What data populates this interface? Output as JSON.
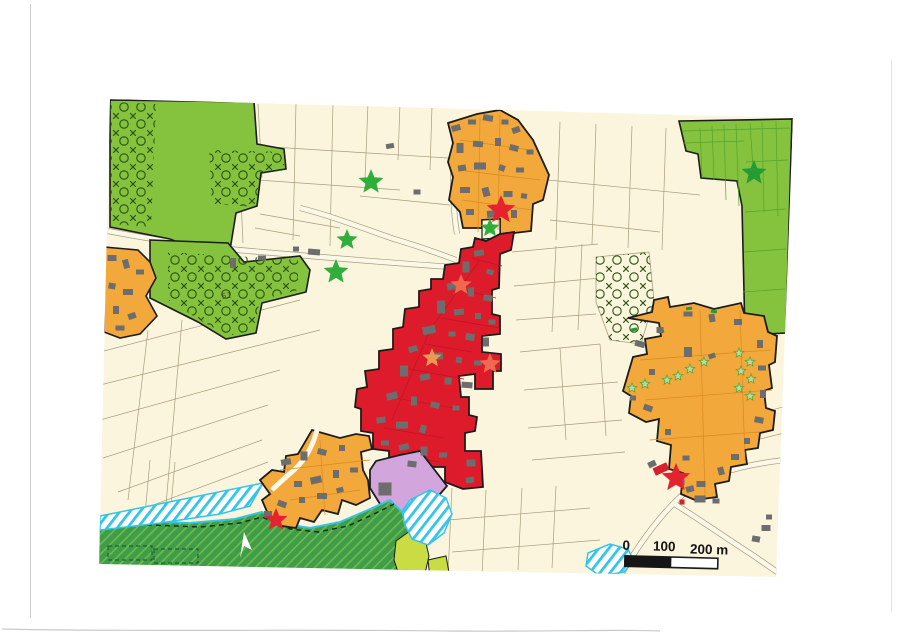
{
  "page": {
    "background": "#ffffff"
  },
  "map": {
    "colors": {
      "paper": "#ffffff",
      "field_beige": "#faf5dc",
      "road_fill": "#fcf8e8",
      "zone_green": "#85c23d",
      "zone_green_dark": "#3f9d4a",
      "zone_chartreuse": "#cadc44",
      "zone_orange": "#f2a83a",
      "zone_red": "#dd1b2b",
      "zone_purple": "#d2a5dc",
      "cyan": "#35c4e8",
      "building_gray": "#6e6d6e",
      "building_red": "#d8202c",
      "outline_black": "#1c1c1c",
      "parcel_line": "#a79d7e",
      "pattern_ink": "#27500f",
      "red_inner_line": "#c01425",
      "orange_inner_line": "#d98a1f",
      "star_green": "#2fae3c",
      "star_dark_green": "#259b35",
      "star_red": "#e52330",
      "star_faint_red": "#ee6a4f",
      "star_faint_orange": "#e89a55",
      "star_pale_green": "#badc9a",
      "star_pale_outline": "#58a546",
      "scale_black": "#161616"
    },
    "scale_bar": {
      "tick_0": "0",
      "tick_100": "100",
      "tick_200": "200 m"
    },
    "labels": {
      "parcel_number": "51"
    },
    "stars": [
      {
        "name": "green-star",
        "x": 371,
        "y": 182,
        "size": 13,
        "color": "star_green"
      },
      {
        "name": "green-star",
        "x": 347,
        "y": 240,
        "size": 11,
        "color": "star_green"
      },
      {
        "name": "green-star",
        "x": 336,
        "y": 272,
        "size": 13,
        "color": "star_green"
      },
      {
        "name": "green-star",
        "x": 490,
        "y": 228,
        "size": 10,
        "color": "star_green"
      },
      {
        "name": "dark-green-star",
        "x": 754,
        "y": 173,
        "size": 13,
        "color": "star_dark_green"
      },
      {
        "name": "red-star",
        "x": 501,
        "y": 210,
        "size": 15,
        "color": "star_red"
      },
      {
        "name": "red-star",
        "x": 676,
        "y": 478,
        "size": 15,
        "color": "star_red"
      },
      {
        "name": "red-star",
        "x": 276,
        "y": 520,
        "size": 12,
        "color": "star_red"
      },
      {
        "name": "faint-red-star",
        "x": 461,
        "y": 285,
        "size": 11,
        "color": "star_faint_red"
      },
      {
        "name": "faint-orange-star",
        "x": 432,
        "y": 358,
        "size": 10,
        "color": "star_faint_orange"
      },
      {
        "name": "faint-red-star",
        "x": 490,
        "y": 364,
        "size": 11,
        "color": "star_faint_red"
      },
      {
        "name": "pale-green-star",
        "x": 739,
        "y": 353,
        "size": 5,
        "color": "star_pale_green",
        "outline": "star_pale_outline"
      },
      {
        "name": "pale-green-star",
        "x": 750,
        "y": 362,
        "size": 5,
        "color": "star_pale_green",
        "outline": "star_pale_outline"
      },
      {
        "name": "pale-green-star",
        "x": 741,
        "y": 371,
        "size": 5,
        "color": "star_pale_green",
        "outline": "star_pale_outline"
      },
      {
        "name": "pale-green-star",
        "x": 751,
        "y": 379,
        "size": 5,
        "color": "star_pale_green",
        "outline": "star_pale_outline"
      },
      {
        "name": "pale-green-star",
        "x": 739,
        "y": 388,
        "size": 5,
        "color": "star_pale_green",
        "outline": "star_pale_outline"
      },
      {
        "name": "pale-green-star",
        "x": 750,
        "y": 396,
        "size": 5,
        "color": "star_pale_green",
        "outline": "star_pale_outline"
      },
      {
        "name": "pale-green-star",
        "x": 704,
        "y": 362,
        "size": 5,
        "color": "star_pale_green",
        "outline": "star_pale_outline"
      },
      {
        "name": "pale-green-star",
        "x": 690,
        "y": 369,
        "size": 5,
        "color": "star_pale_green",
        "outline": "star_pale_outline"
      },
      {
        "name": "pale-green-star",
        "x": 678,
        "y": 376,
        "size": 5,
        "color": "star_pale_green",
        "outline": "star_pale_outline"
      },
      {
        "name": "pale-green-star",
        "x": 667,
        "y": 380,
        "size": 5,
        "color": "star_pale_green",
        "outline": "star_pale_outline"
      },
      {
        "name": "pale-green-star",
        "x": 645,
        "y": 384,
        "size": 5,
        "color": "star_pale_green",
        "outline": "star_pale_outline"
      },
      {
        "name": "pale-green-star",
        "x": 632,
        "y": 388,
        "size": 5,
        "color": "star_pale_green",
        "outline": "star_pale_outline"
      }
    ],
    "buildings": {
      "gray": [
        [
          456,
          128,
          9,
          6,
          -15
        ],
        [
          472,
          122,
          8,
          5,
          0
        ],
        [
          488,
          118,
          10,
          6,
          10
        ],
        [
          505,
          122,
          7,
          5,
          0
        ],
        [
          516,
          130,
          8,
          6,
          -20
        ],
        [
          460,
          148,
          7,
          10,
          0
        ],
        [
          478,
          144,
          10,
          6,
          5
        ],
        [
          498,
          142,
          6,
          8,
          0
        ],
        [
          514,
          148,
          9,
          6,
          15
        ],
        [
          530,
          152,
          7,
          5,
          0
        ],
        [
          462,
          168,
          8,
          6,
          -10
        ],
        [
          480,
          166,
          12,
          7,
          0
        ],
        [
          502,
          168,
          6,
          6,
          20
        ],
        [
          520,
          170,
          8,
          5,
          0
        ],
        [
          465,
          190,
          10,
          6,
          0
        ],
        [
          486,
          192,
          7,
          9,
          -15
        ],
        [
          508,
          194,
          9,
          6,
          0
        ],
        [
          524,
          196,
          6,
          5,
          10
        ],
        [
          470,
          212,
          8,
          6,
          0
        ],
        [
          492,
          214,
          10,
          7,
          -5
        ],
        [
          514,
          214,
          6,
          8,
          0
        ],
        [
          479,
          253,
          10,
          6,
          -8
        ],
        [
          466,
          267,
          7,
          11,
          0
        ],
        [
          490,
          272,
          7,
          5,
          15
        ],
        [
          453,
          286,
          12,
          7,
          -12
        ],
        [
          471,
          292,
          6,
          9,
          0
        ],
        [
          488,
          298,
          9,
          6,
          8
        ],
        [
          441,
          307,
          8,
          13,
          0
        ],
        [
          459,
          312,
          10,
          6,
          -6
        ],
        [
          478,
          316,
          6,
          6,
          0
        ],
        [
          492,
          322,
          7,
          5,
          0
        ],
        [
          429,
          330,
          13,
          8,
          -12
        ],
        [
          452,
          334,
          7,
          5,
          0
        ],
        [
          470,
          337,
          9,
          7,
          12
        ],
        [
          486,
          342,
          6,
          9,
          0
        ],
        [
          413,
          349,
          9,
          6,
          -18
        ],
        [
          437,
          356,
          12,
          7,
          0
        ],
        [
          459,
          360,
          6,
          6,
          8
        ],
        [
          478,
          363,
          8,
          5,
          0
        ],
        [
          404,
          371,
          8,
          11,
          0
        ],
        [
          425,
          377,
          10,
          6,
          -10
        ],
        [
          448,
          381,
          7,
          7,
          0
        ],
        [
          467,
          385,
          11,
          6,
          4
        ],
        [
          392,
          396,
          11,
          7,
          -14
        ],
        [
          414,
          401,
          6,
          9,
          0
        ],
        [
          435,
          405,
          9,
          6,
          12
        ],
        [
          456,
          408,
          7,
          5,
          0
        ],
        [
          381,
          420,
          9,
          6,
          -8
        ],
        [
          402,
          425,
          12,
          7,
          0
        ],
        [
          423,
          429,
          6,
          8,
          16
        ],
        [
          385,
          443,
          8,
          5,
          0
        ],
        [
          404,
          447,
          10,
          6,
          -12
        ],
        [
          424,
          451,
          7,
          9,
          0
        ],
        [
          443,
          455,
          8,
          5,
          0
        ],
        [
          412,
          464,
          9,
          6,
          6
        ],
        [
          471,
          463,
          9,
          7,
          0
        ],
        [
          470,
          480,
          8,
          6,
          -10
        ],
        [
          112,
          258,
          9,
          6,
          0
        ],
        [
          126,
          264,
          6,
          9,
          -15
        ],
        [
          140,
          272,
          8,
          5,
          0
        ],
        [
          112,
          286,
          7,
          6,
          10
        ],
        [
          128,
          292,
          10,
          6,
          0
        ],
        [
          116,
          310,
          6,
          8,
          0
        ],
        [
          132,
          316,
          8,
          6,
          -20
        ],
        [
          120,
          328,
          9,
          5,
          0
        ],
        [
          286,
          462,
          10,
          6,
          -10
        ],
        [
          304,
          456,
          7,
          9,
          0
        ],
        [
          322,
          452,
          9,
          6,
          15
        ],
        [
          342,
          448,
          6,
          6,
          0
        ],
        [
          298,
          484,
          8,
          6,
          0
        ],
        [
          316,
          480,
          11,
          7,
          -12
        ],
        [
          336,
          474,
          6,
          8,
          0
        ],
        [
          354,
          470,
          8,
          5,
          0
        ],
        [
          282,
          504,
          9,
          6,
          20
        ],
        [
          302,
          500,
          6,
          6,
          0
        ],
        [
          322,
          496,
          10,
          6,
          0
        ],
        [
          340,
          490,
          7,
          5,
          -15
        ],
        [
          268,
          514,
          8,
          6,
          0
        ],
        [
          738,
          322,
          8,
          6,
          0
        ],
        [
          712,
          318,
          6,
          8,
          -10
        ],
        [
          688,
          314,
          9,
          5,
          0
        ],
        [
          660,
          330,
          7,
          6,
          0
        ],
        [
          640,
          344,
          10,
          6,
          15
        ],
        [
          652,
          372,
          6,
          6,
          0
        ],
        [
          688,
          352,
          8,
          10,
          0
        ],
        [
          712,
          356,
          7,
          5,
          -20
        ],
        [
          760,
          344,
          6,
          8,
          0
        ],
        [
          762,
          368,
          8,
          5,
          0
        ],
        [
          763,
          394,
          6,
          8,
          0
        ],
        [
          759,
          420,
          9,
          6,
          10
        ],
        [
          747,
          441,
          6,
          6,
          0
        ],
        [
          735,
          457,
          8,
          6,
          0
        ],
        [
          721,
          471,
          6,
          8,
          -15
        ],
        [
          701,
          484,
          9,
          6,
          0
        ],
        [
          686,
          458,
          7,
          5,
          0
        ],
        [
          668,
          432,
          6,
          6,
          0
        ],
        [
          648,
          408,
          9,
          6,
          20
        ],
        [
          633,
          398,
          6,
          5,
          0
        ],
        [
          385,
          489,
          13,
          13,
          0
        ],
        [
          652,
          464,
          8,
          6,
          -25
        ],
        [
          681,
          482,
          7,
          6,
          0
        ],
        [
          690,
          489,
          8,
          6,
          -15
        ],
        [
          700,
          499,
          11,
          7,
          0
        ],
        [
          716,
          501,
          7,
          5,
          0
        ],
        [
          766,
          528,
          9,
          6,
          0
        ],
        [
          756,
          539,
          8,
          6,
          10
        ],
        [
          769,
          517,
          6,
          5,
          0
        ],
        [
          417,
          192,
          7,
          5,
          0
        ],
        [
          390,
          146,
          8,
          5,
          -10
        ],
        [
          314,
          252,
          12,
          6,
          5
        ],
        [
          233,
          263,
          6,
          10,
          0
        ],
        [
          262,
          258,
          8,
          5,
          0
        ],
        [
          296,
          249,
          6,
          5,
          0
        ]
      ],
      "red": [
        [
          661,
          469,
          15,
          8,
          -25
        ],
        [
          682,
          502,
          5,
          5,
          0
        ]
      ]
    }
  }
}
